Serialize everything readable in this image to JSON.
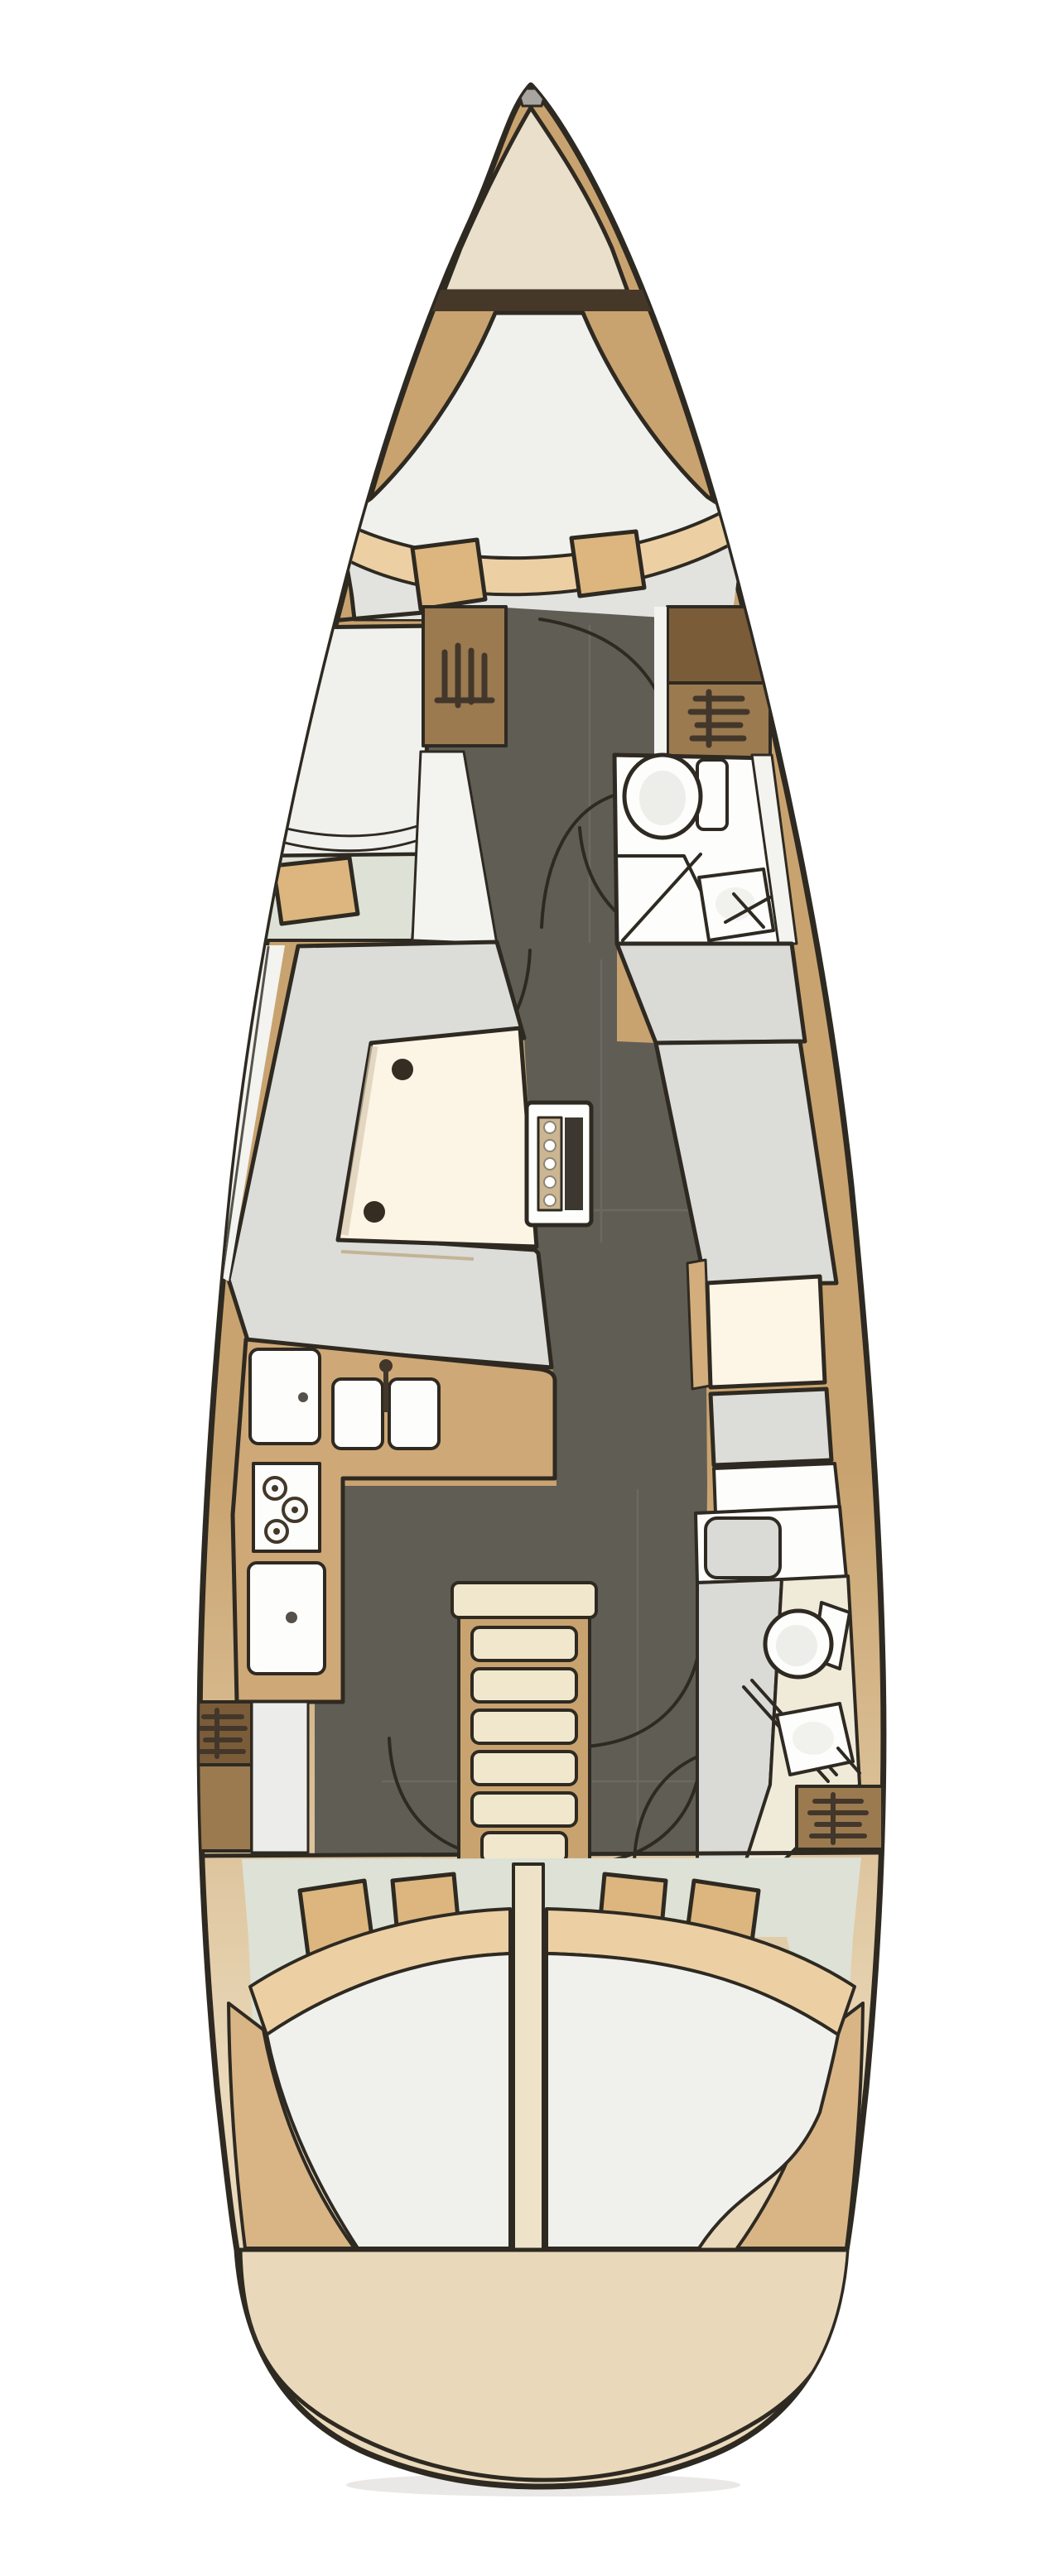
{
  "page": {
    "title": "Sailing yacht interior deck plan (top-down floor plan)",
    "background": "#ffffff"
  },
  "palette": {
    "bg": "#ffffff",
    "line": "#2e2a22",
    "hullTan": "#c9a36f",
    "hullBeige": "#ead9ba",
    "bowWedge": "#e9dfca",
    "bulkhead": "#463828",
    "corridor": "#605d55",
    "seam": "#76736b",
    "mattWhite": "#f0f1ed",
    "mattGray": "#e2e3df",
    "blanket": "#ecd0a4",
    "pillow": "#dcb67e",
    "floorGreen": "#dde1d6",
    "sofa": "#dcdcd8",
    "deckWhite": "#f3f3f0",
    "tableCream": "#fcf4e4",
    "counterTan": "#cfa877",
    "brownMid": "#9b7a50",
    "brownDark": "#7b5c39",
    "iconInk": "#42372a",
    "fixWhite": "#fdfdfc",
    "fixGray": "#dadad6",
    "navCream": "#fdf6e7",
    "navSeatTan": "#d3ad7b",
    "stepsCream": "#f1e7cd",
    "stepsTan": "#c9a36f",
    "divider": "#eee3c8",
    "transom": "#e9d9ba",
    "shadow": "#dddcd9",
    "sternWedgeTan": "#d9b586",
    "tableDotStrip": "#cbb691",
    "tableDarkStrip": "#3c382f",
    "padDark": "#352d22",
    "bowFitting": "#a8a5a0",
    "headFloorCream": "#f0ead9",
    "lockerStrip": "#ecedea"
  },
  "plan": {
    "vessel": {
      "label": "Sailboat hull, bow up, single-deck interior layout",
      "orientation": "bow-up"
    },
    "rooms": {
      "anchorLocker": {
        "label": "Bow anchor locker"
      },
      "forwardCabin": {
        "label": "Forward cabin with V-berth, blanket and two pillows"
      },
      "portCabin": {
        "label": "Port berth cabin with pillow"
      },
      "wardrobeForwardPort": {
        "label": "Port hanging locker"
      },
      "wardrobeForwardStarboard": {
        "label": "Starboard hanging locker"
      },
      "forwardHead": {
        "label": "Forward head with toilet and washbasin"
      },
      "corridor": {
        "label": "Central passageway with door swings"
      },
      "salon": {
        "label": "Salon with U-shaped settee"
      },
      "diningTable": {
        "label": "Salon dining table with corner pads"
      },
      "foldingTable": {
        "label": "Centerline folding cockpit-style table"
      },
      "navStation": {
        "label": "Chart table and navigator seat"
      },
      "galley": {
        "label": "L-shaped galley with fridge, double sink, three-burner stove and oven"
      },
      "companionway": {
        "label": "Companionway steps"
      },
      "aftHead": {
        "label": "Aft head with seat, toilet and washbasin"
      },
      "aftLockerPort": {
        "label": "Port aft hanging locker"
      },
      "aftLockerStarboard": {
        "label": "Starboard aft hanging locker"
      },
      "portAftCabin": {
        "label": "Port aft double berth cabin"
      },
      "starboardAftCabin": {
        "label": "Starboard aft double berth cabin"
      },
      "transom": {
        "label": "Rounded stern transom"
      }
    },
    "counts": {
      "berths": 4,
      "pillows": 7,
      "toilets": 2,
      "washbasins": 2,
      "galley_sink_bowls": 2,
      "stove_burners": 3,
      "companionway_treads": 6,
      "hanger_icons": 4,
      "door_swing_arcs": 8
    }
  }
}
